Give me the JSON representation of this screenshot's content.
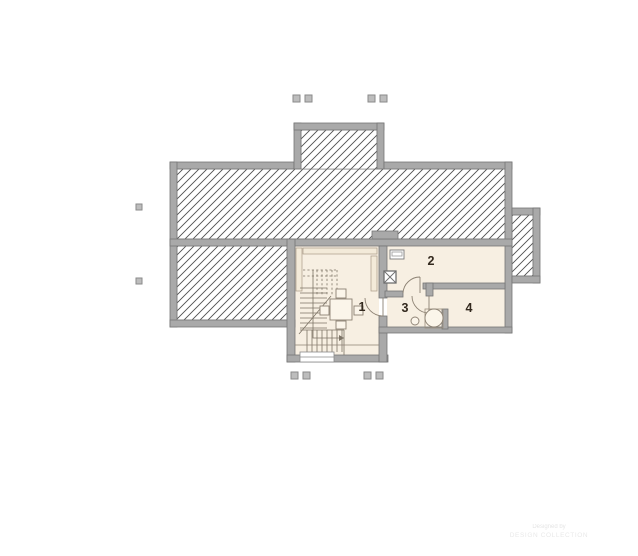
{
  "plan": {
    "rooms": [
      {
        "number": "1"
      },
      {
        "number": "2"
      },
      {
        "number": "3"
      },
      {
        "number": "4"
      }
    ],
    "watermark": {
      "line1": "Designed by",
      "line2": "DESIGN COLLECTION"
    },
    "colors": {
      "wall": "#a9a9a9",
      "room_fill": "#f7efe2",
      "hatch_line": "#4f4f4f",
      "label": "#33291e"
    }
  }
}
